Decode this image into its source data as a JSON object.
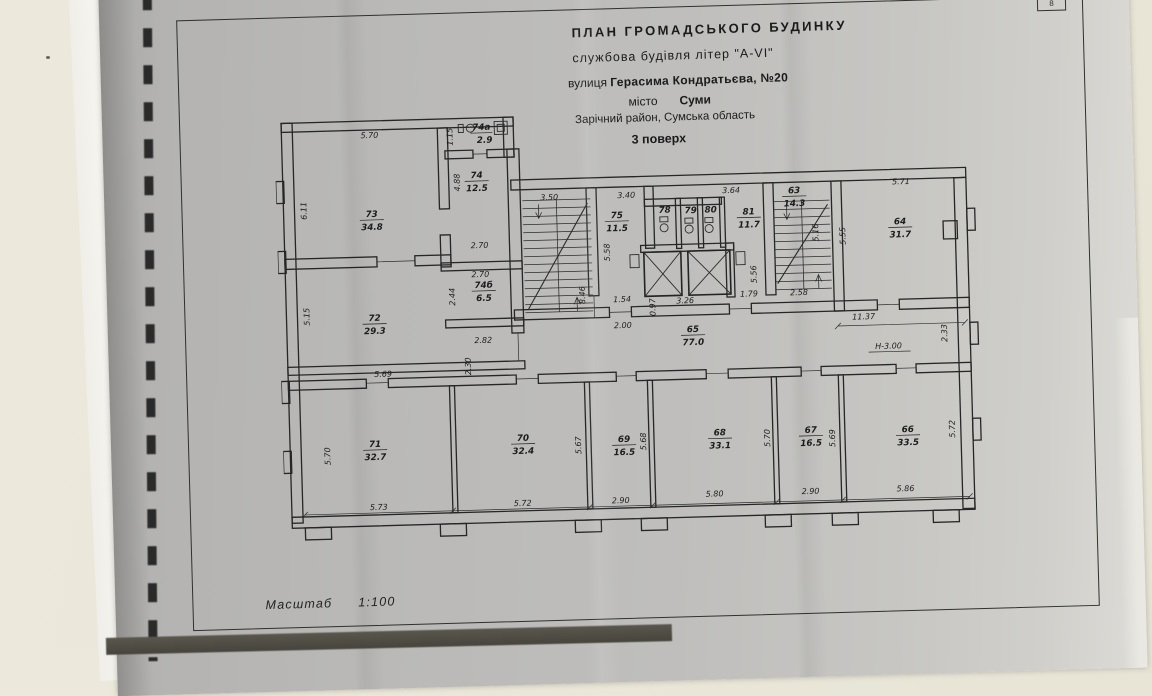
{
  "photo": {
    "page_marker": "8"
  },
  "title_block": {
    "line1": "ПЛАН  ГРОМАДСЬКОГО  БУДИНКУ",
    "line2": "службова будівля літер \"А-VI\"",
    "line3_prefix": "вулиця",
    "line3_value": "Герасима Кондратьєва, №20",
    "line4_prefix": "місто",
    "line4_value": "Суми",
    "line5": "Зарічний район, Сумська область",
    "line6": "3 поверх"
  },
  "scale": {
    "label": "Масштаб",
    "value": "1:100"
  },
  "plan": {
    "rooms": {
      "r73": {
        "num": "73",
        "area": "34.8"
      },
      "r74a": {
        "num": "74а",
        "area": "2.9"
      },
      "r74": {
        "num": "74",
        "area": "12.5"
      },
      "r74b": {
        "num": "74б",
        "area": "6.5"
      },
      "r72": {
        "num": "72",
        "area": "29.3"
      },
      "r71": {
        "num": "71",
        "area": "32.7"
      },
      "r70": {
        "num": "70",
        "area": "32.4"
      },
      "r69": {
        "num": "69",
        "area": "16.5"
      },
      "r68": {
        "num": "68",
        "area": "33.1"
      },
      "r67": {
        "num": "67",
        "area": "16.5"
      },
      "r66": {
        "num": "66",
        "area": "33.5"
      },
      "r65": {
        "num": "65",
        "area": "77.0"
      },
      "r75": {
        "num": "75",
        "area": "11.5"
      },
      "r78": {
        "num": "78"
      },
      "r79": {
        "num": "79"
      },
      "r80": {
        "num": "80"
      },
      "r81": {
        "num": "81",
        "area": "11.7"
      },
      "r63": {
        "num": "63",
        "area": "14.3"
      },
      "r64": {
        "num": "64",
        "area": "31.7"
      }
    },
    "dims": {
      "top73": "5.70",
      "left73": "6.11",
      "h74a": "1.15",
      "left74": "4.88",
      "w74": "2.70",
      "w74b": "2.70",
      "left74b": "2.44",
      "d282": "2.82",
      "d230": "2.30",
      "left72": "5.15",
      "top71": "5.69",
      "left71": "5.70",
      "bot71": "5.73",
      "stairLw": "3.50",
      "stairLh": "8.46",
      "top75": "3.40",
      "left75": "5.58",
      "d154": "1.54",
      "d097": "0.97",
      "d326": "3.26",
      "d200": "2.00",
      "top81": "3.64",
      "right81": "5.56",
      "d179": "1.79",
      "d258": "2.58",
      "stairRh": "5.16",
      "top64": "5.71",
      "left64": "5.55",
      "d1137": "11.37",
      "hmark": "Н-3.00",
      "d233": "2.33",
      "right70": "5.67",
      "bot70": "5.72",
      "right69": "5.68",
      "bot69": "2.90",
      "right68": "5.70",
      "bot68": "5.80",
      "right67": "5.69",
      "bot67": "2.90",
      "right66": "5.72",
      "bot66": "5.86"
    }
  }
}
